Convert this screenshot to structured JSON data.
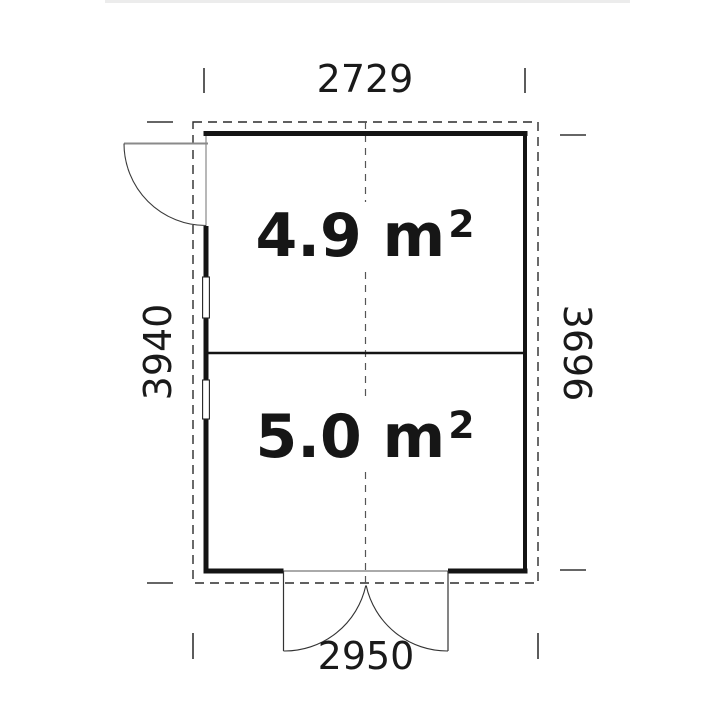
{
  "plan": {
    "dimensions": {
      "width_top": "2729",
      "height_left": "3940",
      "height_right": "3696",
      "width_bottom": "2950"
    },
    "rooms": [
      {
        "label": "4.9 m",
        "sup": "2"
      },
      {
        "label": "5.0 m",
        "sup": "2"
      }
    ],
    "colors": {
      "wall": "#141414",
      "dashed_outline": "#2b2b2b",
      "centerline": "#555555",
      "door_lines": "#8a8a8a",
      "text": "#1a1a1a"
    }
  }
}
